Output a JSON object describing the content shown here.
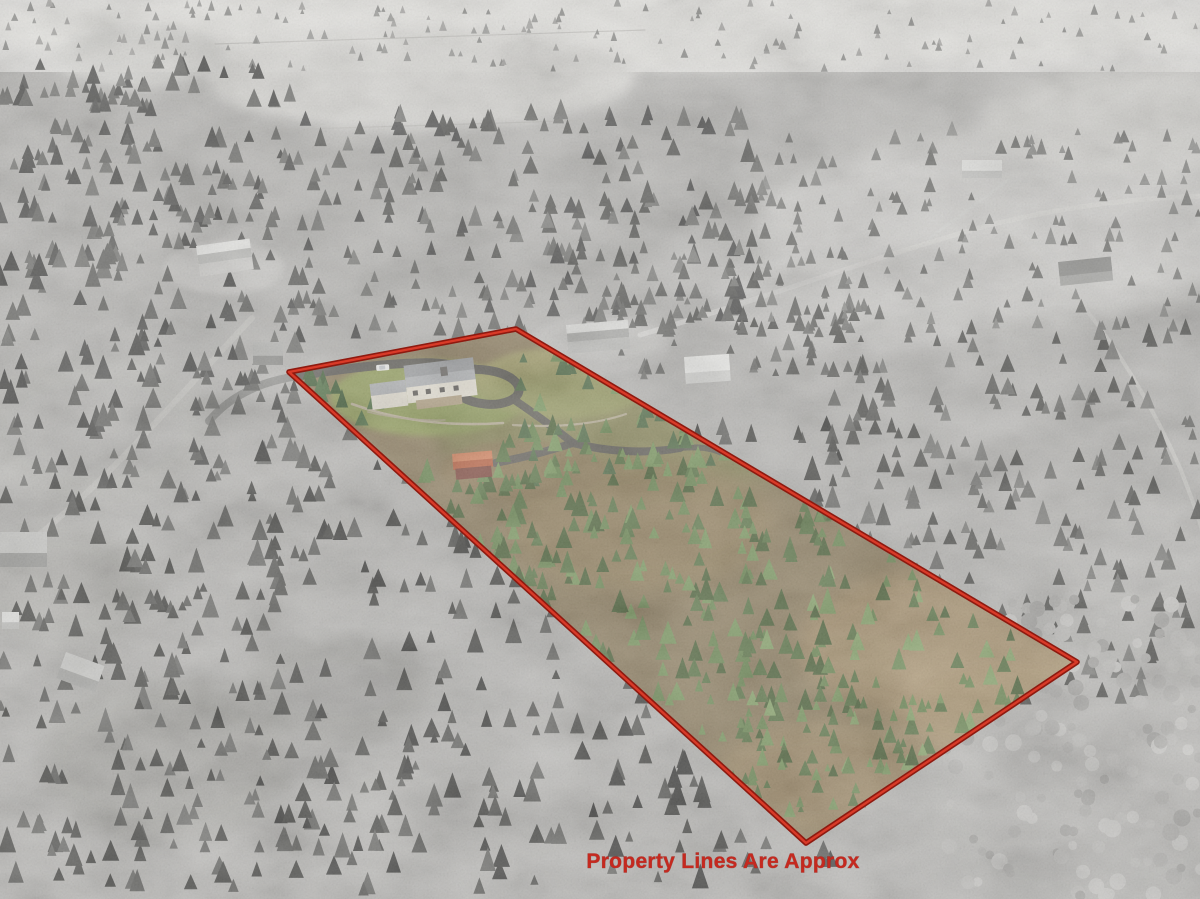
{
  "meta": {
    "type": "aerial-property-photo",
    "description": "Oblique aerial drone photo of a rural wooded acreage; the listed parcel is shown in color inside a red boundary outline while the surrounding landscape is grayscale",
    "width": 1200,
    "height": 899
  },
  "overlay": {
    "caption": "Property Lines Are Approx",
    "caption_color": "#c5291f",
    "caption_font_px": 21,
    "caption_x": 723,
    "caption_y": 868,
    "boundary_points": "289,372 516,329 1077,662 806,843",
    "boundary_outer_color": "#8e1a10",
    "boundary_inner_color": "#d93a28",
    "boundary_outer_width": 5.6,
    "boundary_inner_width": 2.4
  },
  "scene": {
    "background": {
      "base": "#b9b8b5",
      "top_haze": "#e9e8e4"
    },
    "patches": [
      {
        "name": "distant-valley-haze",
        "cx": 600,
        "cy": 28,
        "rx": 640,
        "ry": 42,
        "fill": "#e7e6e2",
        "opacity": 0.95,
        "blur": 6
      },
      {
        "name": "top-center-field",
        "cx": 420,
        "cy": 78,
        "rx": 215,
        "ry": 52,
        "fill": "#dddcd8",
        "opacity": 0.95,
        "blur": 6
      },
      {
        "name": "top-left-field",
        "cx": 140,
        "cy": 58,
        "rx": 85,
        "ry": 30,
        "fill": "#d6d5d1",
        "opacity": 0.9,
        "blur": 6
      },
      {
        "name": "top-right-field-a",
        "cx": 1000,
        "cy": 230,
        "rx": 245,
        "ry": 92,
        "fill": "#d3d2cf",
        "opacity": 0.95,
        "blur": 10
      },
      {
        "name": "top-right-field-b",
        "cx": 855,
        "cy": 300,
        "rx": 145,
        "ry": 52,
        "fill": "#cfcecb",
        "opacity": 0.9,
        "blur": 10
      },
      {
        "name": "top-right-field-c",
        "cx": 1130,
        "cy": 120,
        "rx": 150,
        "ry": 55,
        "fill": "#d8d7d3",
        "opacity": 0.85,
        "blur": 10
      },
      {
        "name": "nw-house-clearing",
        "cx": 224,
        "cy": 268,
        "rx": 60,
        "ry": 27,
        "fill": "#c9c8c5",
        "opacity": 0.9,
        "blur": 3
      },
      {
        "name": "north-house-clearing",
        "cx": 600,
        "cy": 345,
        "rx": 70,
        "ry": 30,
        "fill": "#c6c5c2",
        "opacity": 0.85,
        "blur": 3
      },
      {
        "name": "west-meadow-a",
        "cx": 95,
        "cy": 430,
        "rx": 115,
        "ry": 72,
        "fill": "#bab9b5",
        "opacity": 0.9,
        "blur": 10
      },
      {
        "name": "west-meadow-b",
        "cx": 60,
        "cy": 585,
        "rx": 95,
        "ry": 62,
        "fill": "#b4b3af",
        "opacity": 0.85,
        "blur": 10
      },
      {
        "name": "sw-meadow-a",
        "cx": 165,
        "cy": 760,
        "rx": 125,
        "ry": 82,
        "fill": "#a8a7a3",
        "opacity": 0.8,
        "blur": 10
      },
      {
        "name": "sw-meadow-b",
        "cx": 335,
        "cy": 690,
        "rx": 92,
        "ry": 52,
        "fill": "#a2a19d",
        "opacity": 0.75,
        "blur": 10
      },
      {
        "name": "se-aspen-grove",
        "cx": 1090,
        "cy": 765,
        "rx": 175,
        "ry": 145,
        "fill": "#bcbbb8",
        "opacity": 0.9,
        "blur": 10
      },
      {
        "name": "se-clearing",
        "cx": 1140,
        "cy": 560,
        "rx": 90,
        "ry": 60,
        "fill": "#c2c1be",
        "opacity": 0.7,
        "blur": 10
      }
    ],
    "paths": [
      {
        "name": "road-top-right-main",
        "d": "M 640,335 C 760,300 880,255 990,225 C 1070,205 1140,198 1200,196",
        "stroke": "#d8d7d4",
        "width": 5,
        "opacity": 0.9
      },
      {
        "name": "road-branch-to-house",
        "d": "M 930,238 C 960,215 988,196 1008,180",
        "stroke": "#d4d3d0",
        "width": 3,
        "opacity": 0.85
      },
      {
        "name": "road-to-right-edge",
        "d": "M 1000,228 C 1080,282 1142,382 1180,468 C 1194,504 1200,520 1202,532",
        "stroke": "#cfcecb",
        "width": 4,
        "opacity": 0.8
      },
      {
        "name": "road-left-side",
        "d": "M 252,318 C 212,360 160,420 112,468 C 72,508 30,545 -4,566",
        "stroke": "#c8c7c3",
        "width": 6,
        "opacity": 0.8
      },
      {
        "name": "driveway-entry-gray",
        "d": "M 297,376 C 280,379 264,383 252,389 C 234,397 219,409 209,421",
        "stroke": "#8b8b87",
        "width": 8,
        "opacity": 0.9
      },
      {
        "name": "fence-line-upper",
        "d": "M 215,44 L 645,30",
        "stroke": "#bab9b5",
        "width": 1.2,
        "opacity": 0.7
      },
      {
        "name": "fence-line-lower",
        "d": "M 245,131 L 690,117",
        "stroke": "#bab9b5",
        "width": 1.2,
        "opacity": 0.7
      }
    ],
    "tree_clusters": [
      {
        "name": "distant-treeline",
        "x": 0,
        "y": 6,
        "w": 1200,
        "h": 66,
        "n": 160,
        "rmin": 2,
        "rmax": 4,
        "shape": "cone",
        "seed": 11,
        "palette": [
          "#9a9a97",
          "#8b8b88",
          "#a6a5a2"
        ]
      },
      {
        "name": "forest-left-top",
        "x": 0,
        "y": 66,
        "w": 300,
        "h": 200,
        "n": 150,
        "rmin": 4,
        "rmax": 8,
        "shape": "cone",
        "seed": 21,
        "palette": [
          "#585856",
          "#6a6a67",
          "#4c4c4a",
          "#787875"
        ]
      },
      {
        "name": "forest-left-mid",
        "x": 0,
        "y": 260,
        "w": 300,
        "h": 245,
        "n": 145,
        "rmin": 4,
        "rmax": 9,
        "shape": "cone",
        "seed": 31,
        "palette": [
          "#525250",
          "#646461",
          "#464644",
          "#737370"
        ]
      },
      {
        "name": "forest-left-bottom",
        "x": 0,
        "y": 500,
        "w": 285,
        "h": 395,
        "n": 165,
        "rmin": 4,
        "rmax": 9,
        "shape": "cone",
        "seed": 41,
        "palette": [
          "#4e4e4b",
          "#5f5f5c",
          "#434340",
          "#6b6b68"
        ]
      },
      {
        "name": "forest-center-top",
        "x": 290,
        "y": 118,
        "w": 475,
        "h": 222,
        "n": 235,
        "rmin": 4,
        "rmax": 8,
        "shape": "cone",
        "seed": 51,
        "palette": [
          "#5a5a57",
          "#6c6c69",
          "#7c7c79",
          "#515150"
        ]
      },
      {
        "name": "forest-mid-strip",
        "x": 600,
        "y": 258,
        "w": 265,
        "h": 122,
        "n": 80,
        "rmin": 3,
        "rmax": 7,
        "shape": "cone",
        "seed": 56,
        "palette": [
          "#6a6a67",
          "#7b7b78",
          "#5c5c59"
        ]
      },
      {
        "name": "forest-center-bottom",
        "x": 248,
        "y": 428,
        "w": 610,
        "h": 468,
        "n": 330,
        "rmin": 4,
        "rmax": 9,
        "shape": "cone",
        "seed": 61,
        "palette": [
          "#474744",
          "#585855",
          "#3d3d3b",
          "#676764"
        ]
      },
      {
        "name": "forest-right-mid",
        "x": 830,
        "y": 330,
        "w": 372,
        "h": 392,
        "n": 240,
        "rmin": 4,
        "rmax": 8,
        "shape": "cone",
        "seed": 71,
        "palette": [
          "#5b5b58",
          "#6d6d6a",
          "#4f4f4c",
          "#7e7e7b"
        ]
      },
      {
        "name": "forest-top-right-sparse",
        "x": 760,
        "y": 128,
        "w": 440,
        "h": 210,
        "n": 140,
        "rmin": 3,
        "rmax": 6,
        "shape": "cone",
        "seed": 81,
        "palette": [
          "#7e7e7b",
          "#8e8e8b",
          "#6f6f6c"
        ]
      },
      {
        "name": "aspen-grove-se",
        "x": 938,
        "y": 598,
        "w": 264,
        "h": 300,
        "n": 150,
        "rmin": 4,
        "rmax": 9,
        "shape": "blob",
        "seed": 91,
        "palette": [
          "#b3b2af",
          "#c0bfbc",
          "#a7a6a3",
          "#cbcac7"
        ]
      }
    ],
    "buildings": [
      {
        "name": "neighbor-house-west",
        "x": 196,
        "y": 246,
        "w": 54,
        "h": 31,
        "rot": -8,
        "wall": "#cfcecb",
        "roof": "#ebebe8",
        "roof2": "#bdbdba"
      },
      {
        "name": "gate-shelter",
        "x": 253,
        "y": 342,
        "w": 30,
        "h": 23,
        "rot": 0,
        "wall": "#8f8f8c",
        "roof": "#b5b5b2"
      },
      {
        "name": "neighbor-house-north",
        "x": 566,
        "y": 325,
        "w": 62,
        "h": 29,
        "rot": -5,
        "wall": "#bdbdba",
        "roof": "#dfdfdc",
        "roof2": "#a9a9a6"
      },
      {
        "name": "neighbor-garage-white",
        "x": 684,
        "y": 357,
        "w": 45,
        "h": 27,
        "rot": -4,
        "wall": "#d8d8d5",
        "roof": "#f0f0ed"
      },
      {
        "name": "distant-house-ne",
        "x": 962,
        "y": 160,
        "w": 40,
        "h": 18,
        "rot": 0,
        "wall": "#c8c8c5",
        "roof": "#e9e9e6"
      },
      {
        "name": "barn-west-edge",
        "x": 0,
        "y": 532,
        "w": 47,
        "h": 35,
        "rot": 0,
        "wall": "#9e9e9b",
        "roof": "#c9c9c6"
      },
      {
        "name": "shed-sw-small",
        "x": 2,
        "y": 612,
        "w": 17,
        "h": 17,
        "rot": 0,
        "wall": "#bfbfbc",
        "roof": "#e2e2df"
      },
      {
        "name": "shed-sw-tilted",
        "x": 66,
        "y": 652,
        "w": 41,
        "h": 28,
        "rot": 20,
        "wall": "#b0b0ad",
        "roof": "#d5d5d2"
      },
      {
        "name": "house-se-darkroof",
        "x": 1058,
        "y": 262,
        "w": 53,
        "h": 24,
        "rot": -6,
        "wall": "#a5a5a2",
        "roof": "#8b8b88"
      }
    ],
    "property": {
      "base_fill": "#8f7f60",
      "patches": [
        {
          "name": "lawn-front",
          "cx": 428,
          "cy": 398,
          "rx": 98,
          "ry": 38,
          "fill": "#97a45f",
          "opacity": 0.95,
          "blur": 3
        },
        {
          "name": "pasture-ne-of-house",
          "cx": 562,
          "cy": 383,
          "rx": 88,
          "ry": 36,
          "fill": "#a4a06a",
          "opacity": 0.9,
          "blur": 3
        },
        {
          "name": "grass-top-strip",
          "cx": 640,
          "cy": 430,
          "rx": 205,
          "ry": 62,
          "fill": "#8f9a5e",
          "opacity": 0.5,
          "blur": 10
        },
        {
          "name": "dirt-center",
          "cx": 640,
          "cy": 525,
          "rx": 132,
          "ry": 66,
          "fill": "#93805c",
          "opacity": 0.9,
          "blur": 10
        },
        {
          "name": "dirt-near-shed",
          "cx": 522,
          "cy": 470,
          "rx": 82,
          "ry": 30,
          "fill": "#8d7a58",
          "opacity": 0.85,
          "blur": 3
        },
        {
          "name": "tan-meadow-right-a",
          "cx": 950,
          "cy": 645,
          "rx": 152,
          "ry": 76,
          "fill": "#a8926d",
          "opacity": 0.95,
          "blur": 10
        },
        {
          "name": "tan-meadow-right-b",
          "cx": 1008,
          "cy": 706,
          "rx": 118,
          "ry": 62,
          "fill": "#ae9873",
          "opacity": 0.9,
          "blur": 10
        },
        {
          "name": "dirt-bottom-corner",
          "cx": 828,
          "cy": 778,
          "rx": 112,
          "ry": 58,
          "fill": "#9f8a66",
          "opacity": 0.9,
          "blur": 10
        }
      ],
      "paths": [
        {
          "name": "driveway-entry",
          "d": "M 297,376 C 335,370 378,364 416,363 C 441,362 456,365 463,370",
          "stroke": "#5e5c57",
          "width": 9,
          "opacity": 0.95
        },
        {
          "name": "driveway-loop",
          "d": "M 463,370 C 493,367 517,376 519,389 C 520,399 503,406 485,404 C 467,402 452,394 454,385 C 455,377 463,371 475,369",
          "stroke": "#5e5c57",
          "width": 9,
          "opacity": 0.95
        },
        {
          "name": "driveway-exit-south",
          "d": "M 513,399 C 535,414 557,430 573,443",
          "stroke": "#615f5a",
          "width": 8,
          "opacity": 0.95
        },
        {
          "name": "lower-drive-west",
          "d": "M 573,443 C 546,452 516,459 495,463",
          "stroke": "#615f5a",
          "width": 8,
          "opacity": 0.95
        },
        {
          "name": "lower-drive-east",
          "d": "M 573,443 C 607,452 647,454 680,448",
          "stroke": "#615f5a",
          "width": 8,
          "opacity": 0.95
        },
        {
          "name": "lower-drive-spur",
          "d": "M 680,448 C 702,446 718,449 728,457",
          "stroke": "#615f5a",
          "width": 6,
          "opacity": 0.85
        },
        {
          "name": "stone-wall-upper",
          "d": "M 352,404 C 396,420 448,427 503,423",
          "stroke": "#c3b8a2",
          "width": 2.6,
          "opacity": 0.95
        },
        {
          "name": "stone-wall-east",
          "d": "M 513,425 C 557,428 597,424 626,414",
          "stroke": "#bdb29c",
          "width": 2.2,
          "opacity": 0.9
        },
        {
          "name": "stone-wall-lower",
          "d": "M 368,412 C 393,418 420,421 445,420",
          "stroke": "#b5aa94",
          "width": 1.6,
          "opacity": 0.85
        }
      ],
      "tree_clusters": [
        {
          "name": "parcel-conifers-center",
          "x": 470,
          "y": 430,
          "w": 360,
          "h": 292,
          "n": 210,
          "rmin": 4,
          "rmax": 9,
          "shape": "cone",
          "seed": 101,
          "palette": [
            "#5c7647",
            "#6d8a54",
            "#7c9a60",
            "#4d6339"
          ]
        },
        {
          "name": "parcel-conifers-right",
          "x": 740,
          "y": 520,
          "w": 305,
          "h": 262,
          "n": 150,
          "rmin": 4,
          "rmax": 8,
          "shape": "cone",
          "seed": 111,
          "palette": [
            "#5c7647",
            "#6d8a54",
            "#8aa76c",
            "#4d6339"
          ]
        },
        {
          "name": "parcel-conifers-top-edge",
          "x": 520,
          "y": 350,
          "w": 332,
          "h": 142,
          "n": 85,
          "rmin": 3,
          "rmax": 8,
          "shape": "cone",
          "seed": 121,
          "palette": [
            "#55704a",
            "#6d8a54",
            "#7c9a60"
          ]
        },
        {
          "name": "parcel-conifers-lower-edge",
          "x": 420,
          "y": 480,
          "w": 125,
          "h": 165,
          "n": 55,
          "rmin": 4,
          "rmax": 8,
          "shape": "cone",
          "seed": 131,
          "palette": [
            "#4d6339",
            "#5c7647",
            "#6d8a54"
          ]
        },
        {
          "name": "parcel-conifers-bottom",
          "x": 700,
          "y": 700,
          "w": 245,
          "h": 125,
          "n": 60,
          "rmin": 3,
          "rmax": 7,
          "shape": "cone",
          "seed": 141,
          "palette": [
            "#5c7647",
            "#6d8a54",
            "#7c9a60"
          ]
        },
        {
          "name": "yard-accent-trees",
          "x": 300,
          "y": 378,
          "w": 82,
          "h": 62,
          "n": 12,
          "rmin": 5,
          "rmax": 9,
          "shape": "cone",
          "seed": 151,
          "palette": [
            "#44603a",
            "#55744a"
          ]
        }
      ],
      "house": {
        "name": "main-house",
        "x": 402,
        "y": 370,
        "rot": -7,
        "parts": [
          {
            "name": "west-wing-roof",
            "x": -34,
            "y": 10,
            "w": 36,
            "h": 14,
            "f": "#b2b4b6"
          },
          {
            "name": "west-wing-wall",
            "x": -34,
            "y": 22,
            "w": 36,
            "h": 14,
            "f": "#e8e3d6"
          },
          {
            "name": "main-roof-north",
            "x": 2,
            "y": -4,
            "w": 70,
            "h": 14,
            "f": "#9fa1a3"
          },
          {
            "name": "main-roof-south",
            "x": 2,
            "y": 8,
            "w": 70,
            "h": 12,
            "f": "#b4b6b8"
          },
          {
            "name": "main-south-wall",
            "x": 2,
            "y": 18,
            "w": 70,
            "h": 16,
            "f": "#eae5d8"
          },
          {
            "name": "deck",
            "x": 10,
            "y": 32,
            "w": 46,
            "h": 9,
            "f": "#b7a688"
          },
          {
            "name": "chimney",
            "x": 38,
            "y": 2,
            "w": 7,
            "h": 9,
            "f": "#6f6c68"
          },
          {
            "name": "window-1",
            "x": 8,
            "y": 22,
            "w": 5,
            "h": 5,
            "f": "#5f5c58"
          },
          {
            "name": "window-2",
            "x": 21,
            "y": 22,
            "w": 5,
            "h": 5,
            "f": "#5f5c58"
          },
          {
            "name": "window-3",
            "x": 35,
            "y": 22,
            "w": 5,
            "h": 5,
            "f": "#5f5c58"
          },
          {
            "name": "window-4",
            "x": 49,
            "y": 22,
            "w": 5,
            "h": 5,
            "f": "#5f5c58"
          }
        ]
      },
      "shed": {
        "name": "red-roof-shed",
        "x": 452,
        "y": 454,
        "rot": -5,
        "parts": [
          {
            "name": "shed-roof-upper",
            "x": 0,
            "y": 0,
            "w": 40,
            "h": 9,
            "f": "#d2805a"
          },
          {
            "name": "shed-roof-lower",
            "x": 0,
            "y": 8,
            "w": 40,
            "h": 8,
            "f": "#b65e3e"
          },
          {
            "name": "shed-wall",
            "x": 2,
            "y": 15,
            "w": 36,
            "h": 11,
            "f": "#7c453a"
          }
        ]
      },
      "car": {
        "name": "white-pickup",
        "x": 376,
        "y": 365,
        "rot": -4,
        "parts": [
          {
            "name": "car-body",
            "x": 0,
            "y": 0,
            "w": 13,
            "h": 6,
            "f": "#f3f3f1",
            "rx": 1.5
          },
          {
            "name": "car-cab",
            "x": 3,
            "y": 1,
            "w": 6,
            "h": 4,
            "f": "#c9cdd1",
            "rx": 1
          }
        ]
      }
    }
  }
}
